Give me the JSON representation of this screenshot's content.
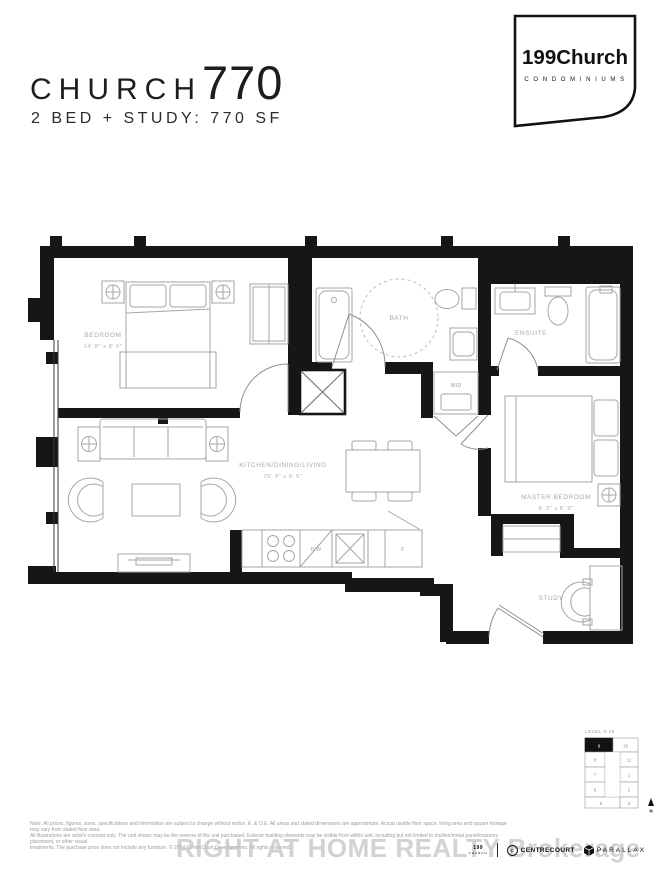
{
  "header": {
    "title_church": "CHURCH",
    "title_number": "770",
    "subtitle": "2 BED + STUDY: 770 SF",
    "logo_name": "199Church",
    "logo_sub": "C O N D O M I N I U M S"
  },
  "plan": {
    "rooms": {
      "bedroom": {
        "name": "BEDROOM",
        "dims": "14' 8\" x 8' 0\""
      },
      "kitchen": {
        "name": "KITCHEN/DINING/LIVING",
        "dims": "25' 9\" x 9' 6\""
      },
      "bath": {
        "name": "BATH"
      },
      "ensuite": {
        "name": "ENSUITE"
      },
      "master": {
        "name": "MASTER BEDROOM",
        "dims": "8' 3\" x 8' 9\""
      },
      "study": {
        "name": "STUDY"
      },
      "wd": {
        "name": "W/D"
      }
    },
    "appliances": {
      "dishwasher": "D/W",
      "fridge": "F"
    }
  },
  "keyplate": {
    "level_label": "LEVEL 6-19",
    "north_label": "N",
    "highlighted_unit": "9",
    "units": [
      {
        "label": "9",
        "highlighted": true
      },
      {
        "label": "10",
        "highlighted": false
      },
      {
        "label": "8",
        "highlighted": false
      },
      {
        "label": "11",
        "highlighted": false
      },
      {
        "label": "7",
        "highlighted": false
      },
      {
        "label": "1",
        "highlighted": false
      },
      {
        "label": "6",
        "highlighted": false
      },
      {
        "label": "2",
        "highlighted": false
      },
      {
        "label": "5",
        "highlighted": false
      },
      {
        "label": "3",
        "highlighted": false
      }
    ]
  },
  "footer": {
    "watermark": "RIGHT AT HOME REALTY Brokerage",
    "disclaimer_lines": [
      "Note: All prices, figures, sizes, specifications and information are subject to change without notice. E. & O.E. All areas and stated dimensions are approximate. Actual usable floor space, living area and square footage may vary from stated floor area.",
      "All illustrations are artist's concept only. The unit shown may be the reverse of the unit purchased. Exterior building elements may be visible from within unit, including but not limited to mullion/metal panel/masonry placement, or other visual",
      "treatments. The purchase price does not include any furniture. © 2024 CentreCourt Developments. All rights reserved."
    ],
    "logos": {
      "brand_line1": "199",
      "brand_line2": "CHURCH",
      "centrecourt_initial": "C",
      "centrecourt": "CENTRECOURT",
      "parallax": "PARALLAX"
    }
  },
  "colors": {
    "wall": "#161616",
    "furniture_line": "#a6a6a6",
    "label_text": "#a8a8a8"
  }
}
